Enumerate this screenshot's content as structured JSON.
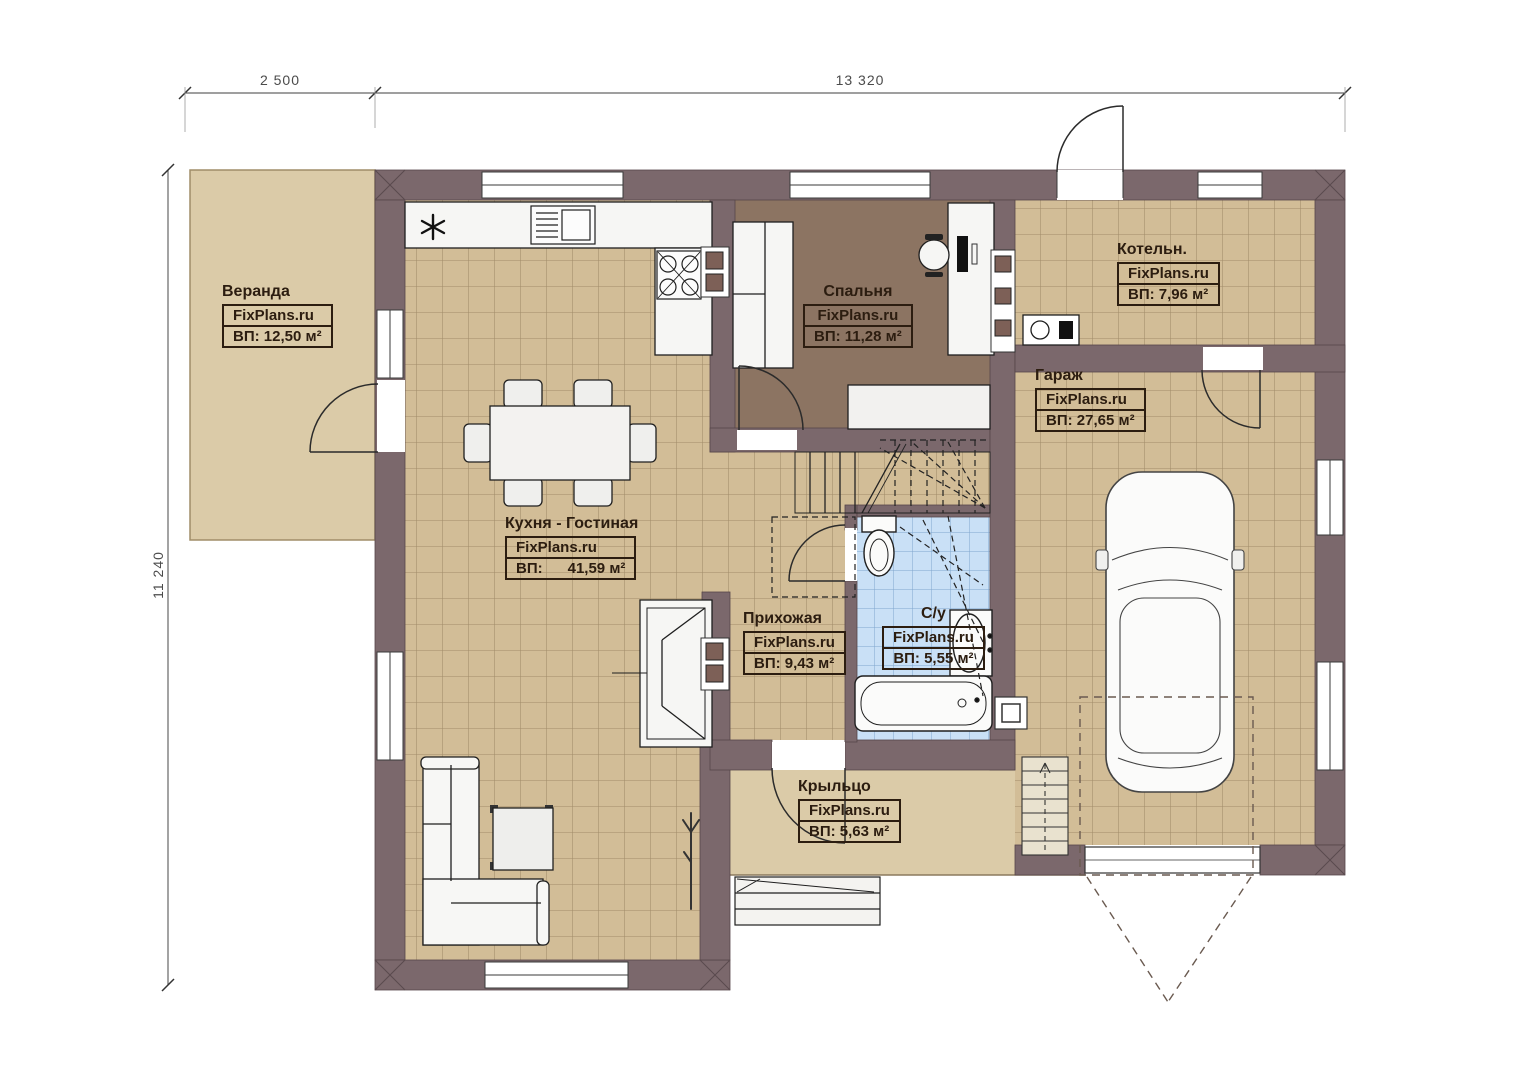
{
  "watermark": "FixPlans.ru",
  "dimensions": {
    "top_left": "2 500",
    "top_right": "13 320",
    "left": "11 240"
  },
  "rooms": [
    {
      "name": "Веранда",
      "area": "ВП: 12,50 м²"
    },
    {
      "name": "Спальня",
      "area": "ВП: 11,28 м²"
    },
    {
      "name": "Котельн.",
      "area": "ВП: 7,96 м²"
    },
    {
      "name": "Гараж",
      "area": "ВП: 27,65 м²"
    },
    {
      "name": "Кухня - Гостиная",
      "area": "ВП:      41,59 м²"
    },
    {
      "name": "Прихожая",
      "area": "ВП: 9,43 м²"
    },
    {
      "name": "С/у",
      "area": "ВП: 5,55 м²"
    },
    {
      "name": "Крыльцо",
      "area": "ВП: 5,63 м²"
    }
  ],
  "colors": {
    "wall": "#7b686c",
    "floor_tile_tan": "#d2bd97",
    "floor_tile_blue": "#c9e0f6",
    "bedroom_floor": "#8c7462",
    "veranda_porch": "#dbcba8",
    "label_ink": "#2c1d10"
  }
}
